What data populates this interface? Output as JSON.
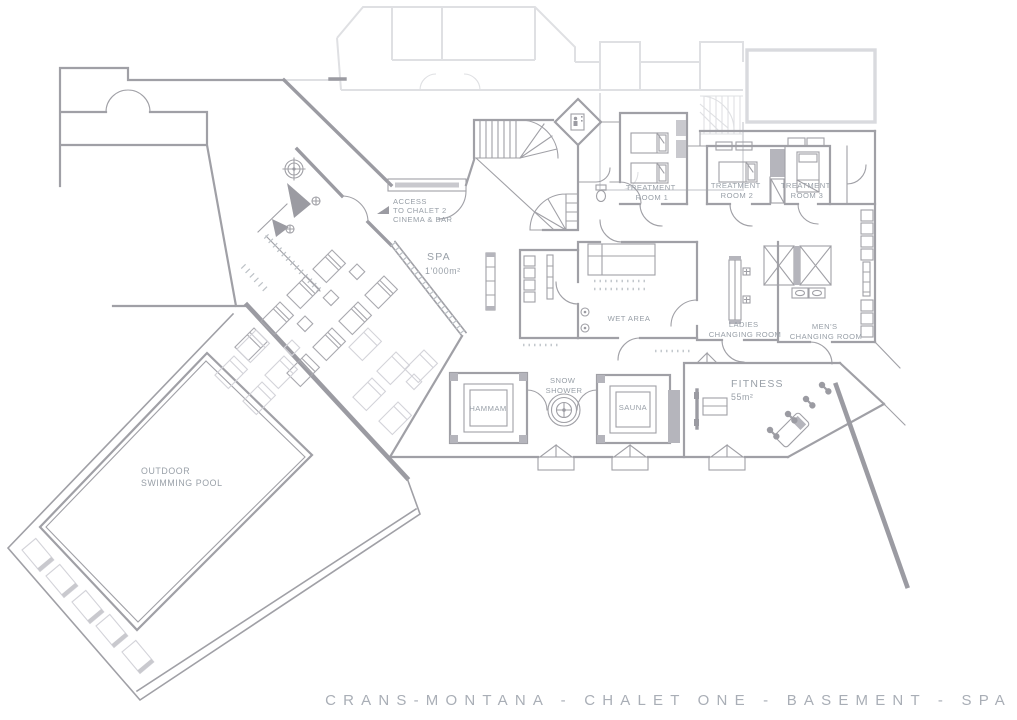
{
  "caption": "CRANS-MONTANA - CHALET ONE - BASEMENT - SPA",
  "labels": {
    "access": {
      "lines": [
        "ACCESS",
        "TO CHALET 2",
        "CINEMA & BAR"
      ]
    },
    "spa": {
      "name": "SPA",
      "area": "1'000m²"
    },
    "treatment_room_1": {
      "lines": [
        "TREATMENT",
        "ROOM 1"
      ]
    },
    "treatment_room_2": {
      "lines": [
        "TREATMENT",
        "ROOM 2"
      ]
    },
    "treatment_room_3": {
      "lines": [
        "TREATMENT",
        "ROOM 3"
      ]
    },
    "wet_area": {
      "name": "WET AREA"
    },
    "ladies_changing": {
      "lines": [
        "LADIES",
        "CHANGING ROOM"
      ]
    },
    "mens_changing": {
      "lines": [
        "MEN'S",
        "CHANGING ROOM"
      ]
    },
    "snow_shower": {
      "lines": [
        "SNOW",
        "SHOWER"
      ]
    },
    "hammam": {
      "name": "HAMMAM"
    },
    "sauna": {
      "name": "SAUNA"
    },
    "fitness": {
      "name": "FITNESS",
      "area": "55m²"
    },
    "outdoor_pool": {
      "lines": [
        "OUTDOOR",
        "SWIMMING POOL"
      ]
    }
  },
  "colors": {
    "wall": "#a0a0a6",
    "upper_floor": "#dfe0e3",
    "dark_fill": "#b5b5bc",
    "label_text": "#99a0a8",
    "caption_text": "#a9aeb6",
    "background": "#ffffff"
  }
}
